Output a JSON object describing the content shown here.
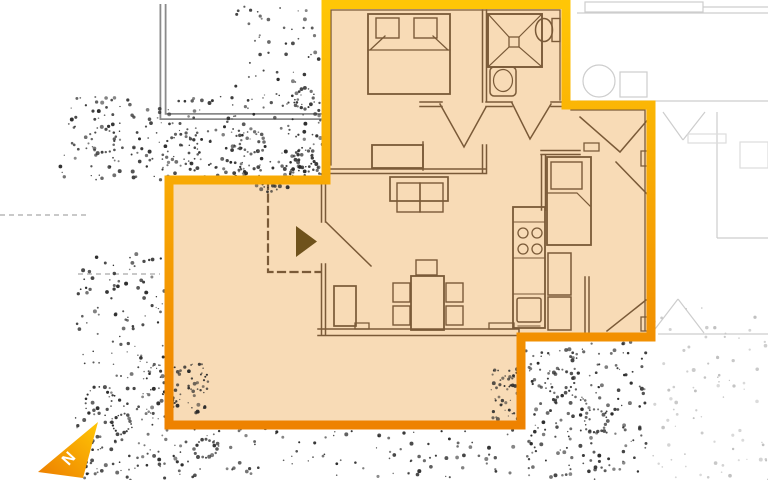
{
  "north": {
    "label": "N"
  },
  "colors": {
    "page_bg": "#FFFFFF",
    "unit_fill": "#F8DBB6",
    "outline_top": "#FFC606",
    "outline_bottom": "#EE8200",
    "wall_brown": "#7A5A38",
    "entrance_arrow": "#6F521C",
    "site_wall_gray": "#8A8A8A",
    "neighbor_faint": "#CDCDCD",
    "neighbor_fainter": "#DDDDDD",
    "site_line_gray": "#A9A9A9",
    "stipple_dark": "#2B2B2B",
    "stipple_faint": "#BFBFBF",
    "north_text": "#FFFFFF"
  },
  "symbols": {
    "north_arrow": "north-arrow",
    "entrance_arrow": "entrance-arrow",
    "vegetation": "stipple-trees",
    "canopy_dashed_line": "dashed-boundary"
  },
  "furniture": [
    "double-bed",
    "pillows",
    "dresser",
    "shower",
    "toilet",
    "washbasin",
    "sofa",
    "armchair",
    "dining-table",
    "five-chairs",
    "kitchen-counter",
    "cooktop-4-burners",
    "oven",
    "cabinets",
    "single-bed"
  ]
}
